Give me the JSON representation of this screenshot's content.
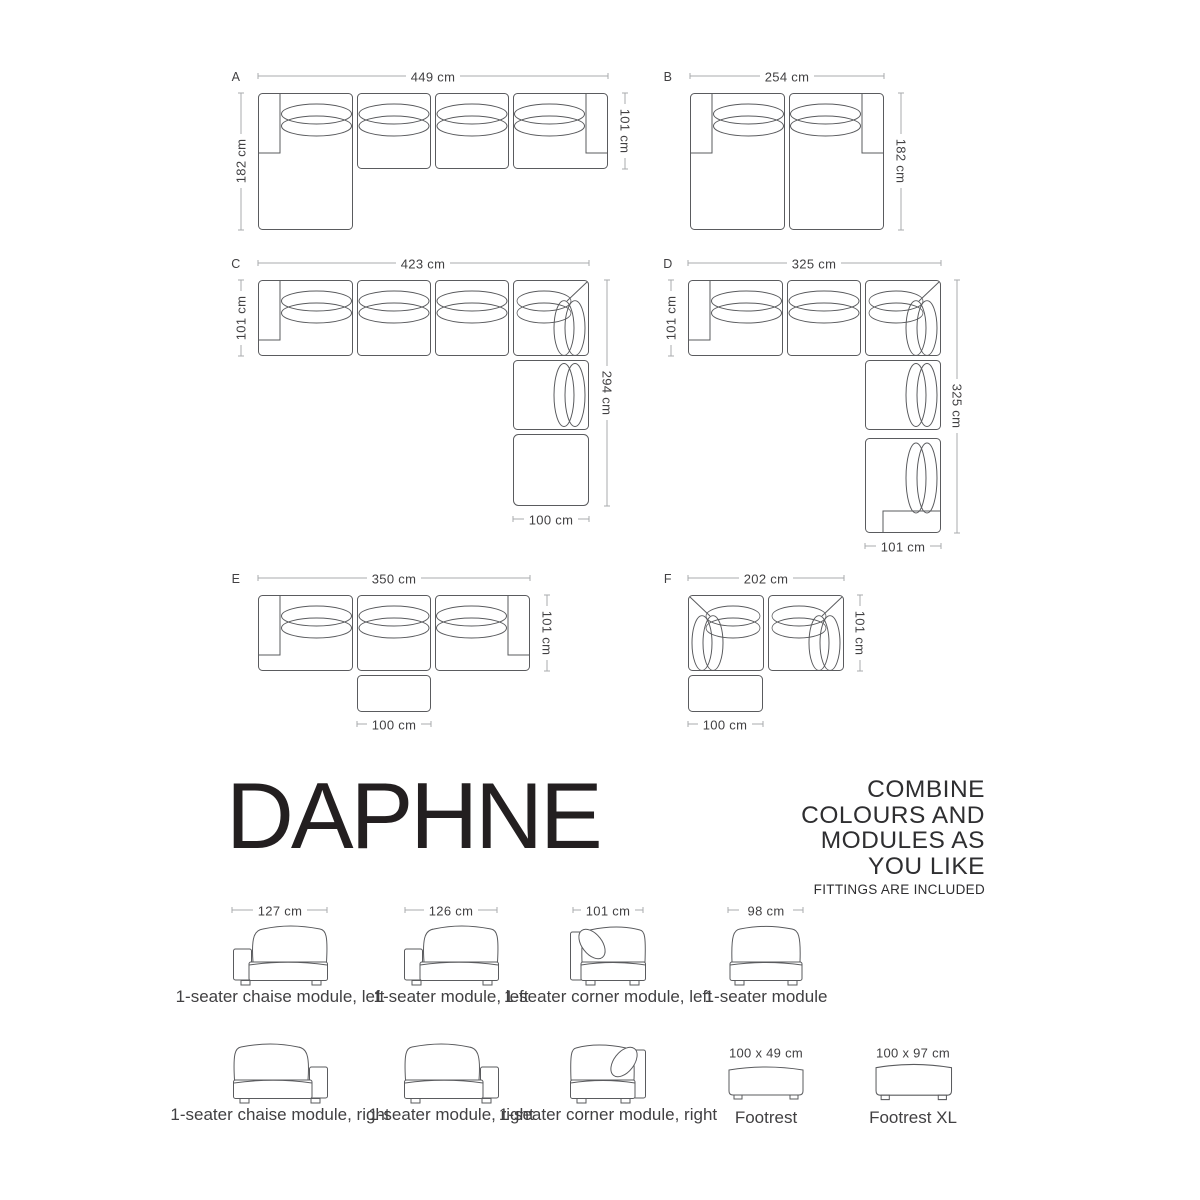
{
  "page": {
    "background": "#ffffff",
    "drawing_line_color": "#5a5b5e",
    "dimension_line_color": "#a8abad",
    "text_color": "#414042",
    "title_color": "#231f20"
  },
  "title": {
    "text": "DAPHNE"
  },
  "tagline": {
    "lines": [
      "COMBINE",
      "COLOURS AND",
      "MODULES AS",
      "YOU LIKE"
    ],
    "note": "FITTINGS ARE INCLUDED"
  },
  "configurations": [
    {
      "id": "A",
      "width_label": "449 cm",
      "left_label": "182 cm",
      "right_label": "101 cm"
    },
    {
      "id": "B",
      "width_label": "254 cm",
      "right_label": "182 cm"
    },
    {
      "id": "C",
      "width_label": "423 cm",
      "left_label": "101 cm",
      "right_label": "294 cm",
      "bottom_label": "100 cm"
    },
    {
      "id": "D",
      "width_label": "325 cm",
      "left_label": "101 cm",
      "right_label": "325 cm",
      "bottom_label": "101 cm"
    },
    {
      "id": "E",
      "width_label": "350 cm",
      "right_label": "101 cm",
      "bottom_label": "100 cm"
    },
    {
      "id": "F",
      "width_label": "202 cm",
      "right_label": "101 cm",
      "bottom_label": "100 cm"
    }
  ],
  "modules": [
    {
      "dim": "127 cm",
      "name": "1-seater chaise module, left"
    },
    {
      "dim": "126 cm",
      "name": "1-seater module, left"
    },
    {
      "dim": "101 cm",
      "name": "1-seater corner module, left"
    },
    {
      "dim": "98 cm",
      "name": "1-seater module"
    },
    {
      "name": "1-seater chaise module, right"
    },
    {
      "name": "1-seater module, right"
    },
    {
      "name": "1-seater corner module, right"
    },
    {
      "dim": "100 x 49 cm",
      "name": "Footrest"
    },
    {
      "dim": "100 x 97 cm",
      "name": "Footrest XL"
    }
  ]
}
